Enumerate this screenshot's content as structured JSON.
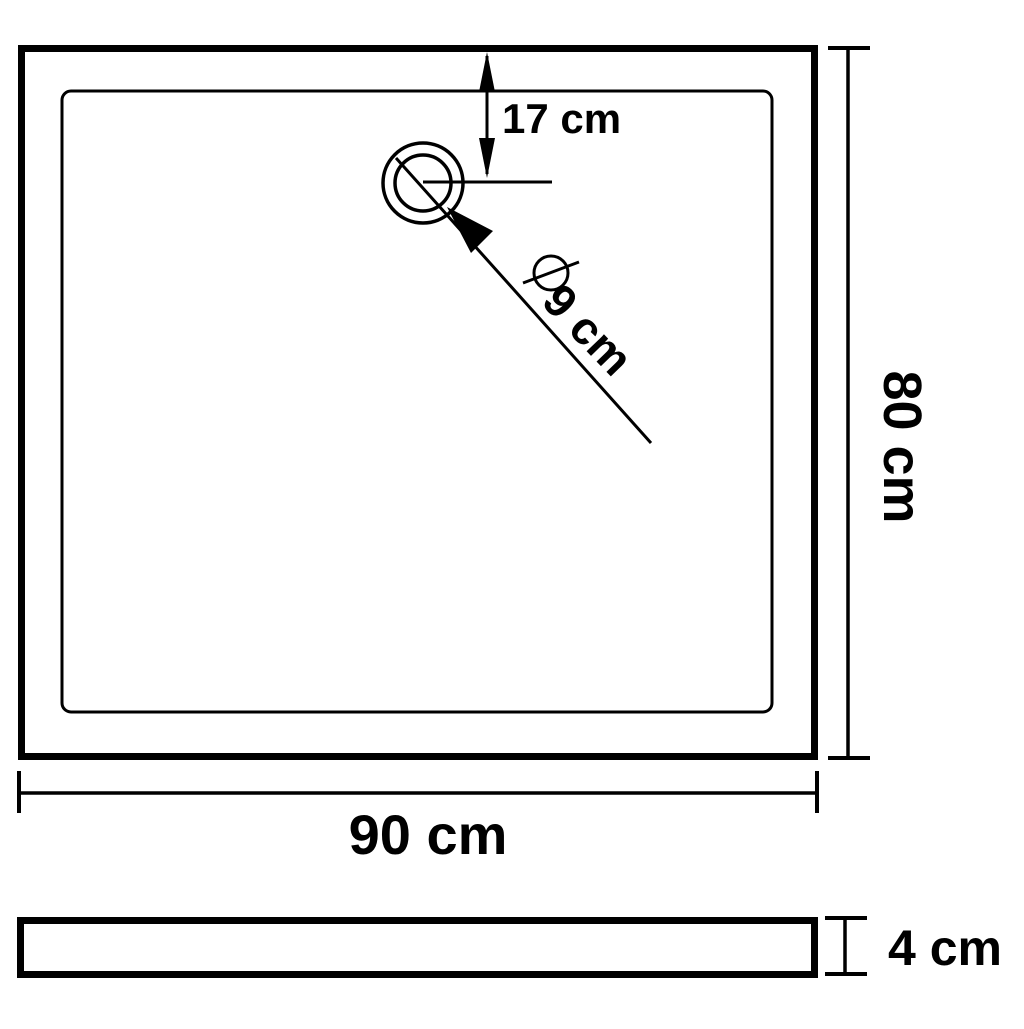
{
  "top_view": {
    "width_label": "90 cm",
    "depth_label": "80 cm",
    "drain_offset_label": "17 cm",
    "drain_diameter_label": "9 cm",
    "diameter_symbol": "⌀"
  },
  "side_view": {
    "height_label": "4 cm"
  },
  "colors": {
    "line": "#000000",
    "background": "#ffffff"
  }
}
